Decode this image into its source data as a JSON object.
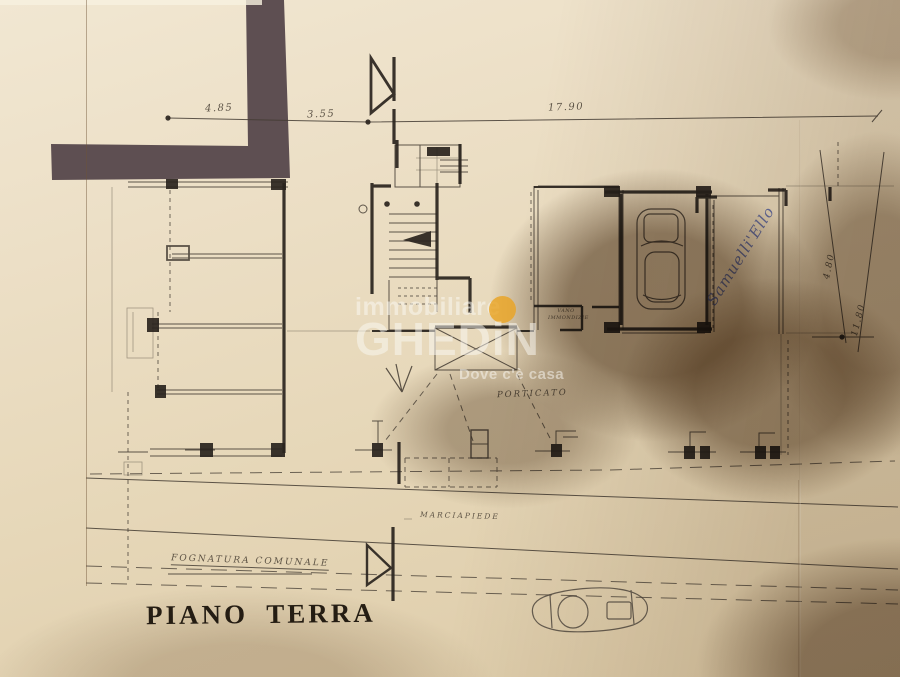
{
  "photo": {
    "plan_title": "PIANO TERRA",
    "labels": {
      "porticato": "PORTICATO",
      "marciapiede": "MARCIAPIEDE",
      "fognatura_comunale": "FOGNATURA COMUNALE",
      "vano_line1": "VANO",
      "vano_line2": "IMMONDIZIE"
    },
    "dimensions": {
      "top": [
        "4.85",
        "3.55",
        "17.90"
      ],
      "right": [
        "4.80",
        "11.80"
      ]
    },
    "handwritten_note": "Samuelli'Ello",
    "watermark": {
      "line1": "immobiliare",
      "brand": "GHEDiN",
      "tagline": "Dove c'è casa",
      "dot_color": "#E9A423"
    },
    "colors": {
      "paper": "#EADDC2",
      "thin_ink": "#433B32",
      "wall_ink": "#2A241E",
      "corner_band": "#57494D",
      "shadow": "#4D341A",
      "note_ink": "#4A57A0",
      "watermark_dot": "#E9A423"
    }
  }
}
